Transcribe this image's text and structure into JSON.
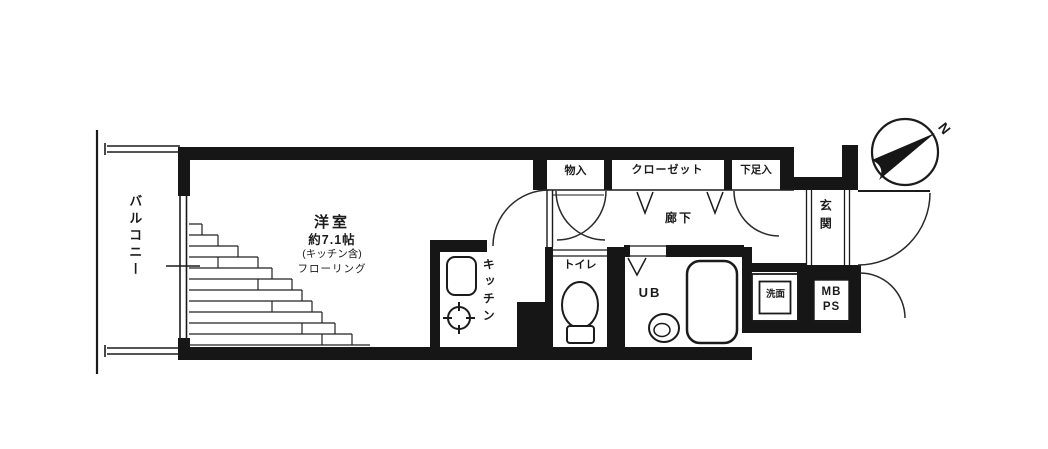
{
  "floorplan": {
    "balcony_label": "バルコニー",
    "room": {
      "name": "洋室",
      "size": "約7.1帖",
      "note": "(キッチン含)",
      "flooring": "フローリング"
    },
    "kitchen_label": "キッチン",
    "storage_label": "物入",
    "closet_label": "クローゼット",
    "shoe_cabinet_label": "下足入",
    "hallway_label": "廊下",
    "toilet_label": "トイレ",
    "unit_bath_label": "UB",
    "entrance_label": "玄関",
    "washstand_label": "洗面",
    "meter_pipe_space_label": "MB\nPS",
    "compass_north_label": "N",
    "colors": {
      "wall": "#161616",
      "line": "#1b1b1b",
      "background": "#ffffff"
    }
  }
}
